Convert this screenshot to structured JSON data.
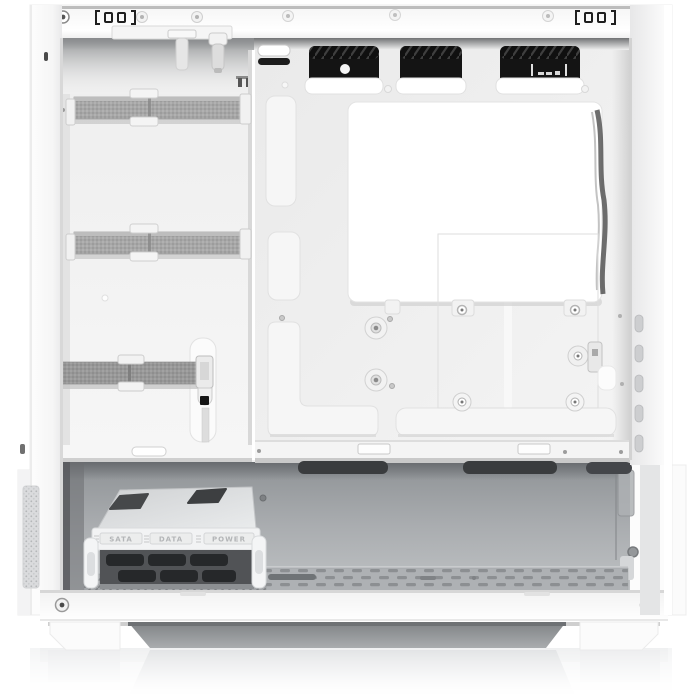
{
  "subject": {
    "type": "product-photo",
    "description": "Interior side view of a white mid-tower PC case with the side panel removed, showing the cable-management side: motherboard tray with black cable grommets, bright white CPU cutout plate, three gray velcro cable straps, SSD mounting points, PSU basement with a white hard-drive caddy, perforated floor, bottom dust filter and feet, on a white studio background with a soft floor reflection."
  },
  "colors": {
    "background": "#ffffff",
    "case_white": "#f7f7f7",
    "tray_gray": "#ececec",
    "strap_gray": "#a7a7a7",
    "grommet_black": "#141414",
    "basement_gray": "#9ea1a4",
    "filter_gray": "#84878a"
  },
  "drive_tray": {
    "labels": [
      "SATA",
      "DATA",
      "POWER"
    ]
  },
  "counts": {
    "velcro_straps": 3,
    "cable_grommets": 3,
    "drive_caddy_labels": 3,
    "motherboard_standoff_screws": 2,
    "top_panel_screws": 7
  },
  "parts": {
    "top_panel": "white top frame rail with rivet screws and panel clip slots",
    "cable_grommets": "three black cable pass-through openings with hatched covers",
    "motherboard_tray": "white tray with stamped routing channels and standoff screws",
    "cpu_cutout_plate": "large bright white rectangular plate with mounting tabs",
    "ssd_mount": "SSD bracket position with rubber-grommet screws and retention clip",
    "velcro_straps": "three gray hook-and-loop cable straps on the left routing channel",
    "psu_basement": "open gray basement compartment",
    "drive_caddy": "white drive tray with embossed connector labels",
    "perforated_floor": "ventilated case floor",
    "dust_filter": "recessed bottom dust filter between case feet",
    "floor_reflection": "soft mirror reflection on glossy floor"
  }
}
